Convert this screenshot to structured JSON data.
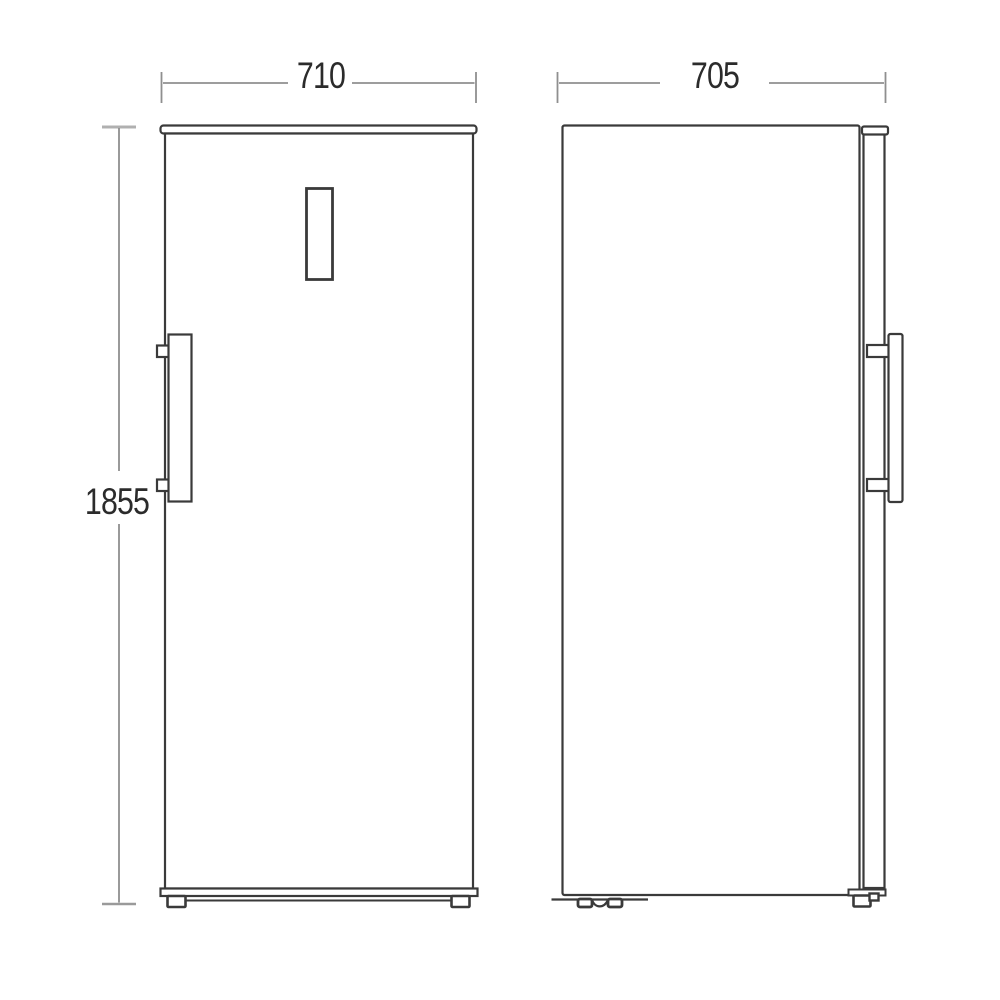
{
  "diagram": {
    "kind": "appliance-dimension-drawing",
    "dimensions": {
      "width_label": "710",
      "depth_label": "705",
      "height_label": "1855"
    },
    "colors": {
      "outline": "#3a3a3a",
      "dimension_line": "#8f8f8f",
      "tick": "#a8a8a8",
      "text": "#2b2b2b",
      "background": "#ffffff"
    }
  }
}
